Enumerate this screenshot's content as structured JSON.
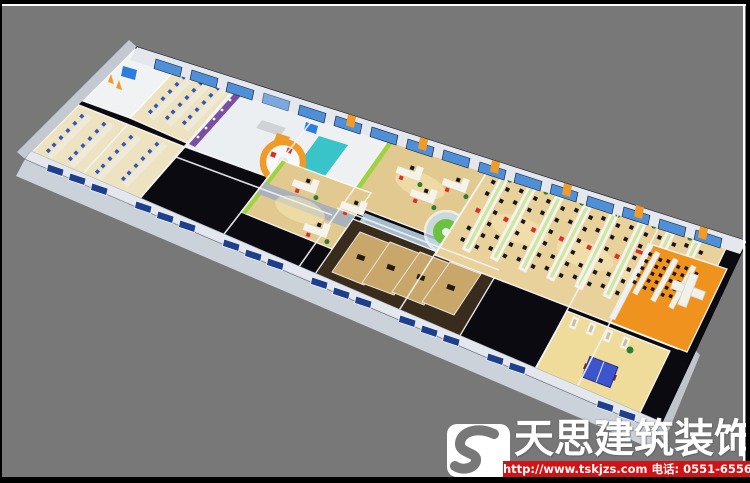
{
  "watermark": {
    "logo_icon": "s-monogram-icon",
    "brand": "天思建筑装饰",
    "contact": "http://www.tskjzs.com 电话: 0551-65568226"
  },
  "colors": {
    "background": "#787878",
    "frame_black": "#000000",
    "frame_white": "#ffffff",
    "roof": "#0a0a10",
    "wall": "#e4e8ee",
    "wall_face": "#ccd2da",
    "window_sky": "#4f8fd8",
    "window_navy": "#1d3f8c",
    "pillar": "#f09a28",
    "floor_warm": "#e2c98f",
    "floor_cream": "#eee3c0",
    "floor_yellow": "#f0dc9a",
    "floor_orange": "#f0921e",
    "lime": "#9ed23e",
    "teal": "#38c4c8",
    "purple": "#7a4fa0",
    "glass": "#c3dcec",
    "meeting_green": "#6cc23e",
    "chair_red": "#d8302a",
    "chair_blue": "#2f55c0",
    "chair_dark": "#17171d",
    "table_blue": "#3c55cc",
    "plant": "#2e7d32",
    "screen": "#2b7de0",
    "brand_red": "#cf1417",
    "wood_dark": "#3a2c1c",
    "wood_floor": "#c9a76a"
  }
}
